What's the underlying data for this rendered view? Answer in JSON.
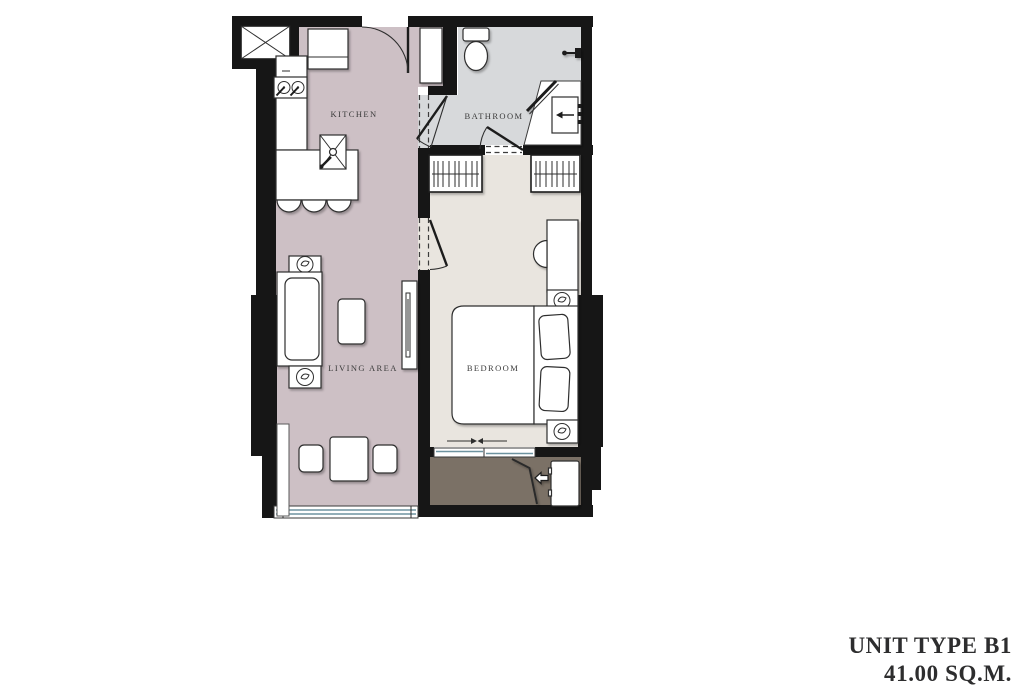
{
  "unit": {
    "title_line1": "UNIT TYPE B1",
    "title_line2": "41.00 SQ.M."
  },
  "rooms": {
    "kitchen": {
      "label": "KITCHEN"
    },
    "bathroom": {
      "label": "BATHROOM"
    },
    "living_area": {
      "label": "LIVING AREA"
    },
    "bedroom": {
      "label": "BEDROOM"
    }
  },
  "colors": {
    "wall": "#161616",
    "kitchen_living_floor": "#cdc0c5",
    "bathroom_floor": "#d7d9db",
    "bedroom_floor": "#e9e5df",
    "balcony_floor": "#7b7166",
    "glazing": "#6e93a0",
    "label_text": "#3a3a3a",
    "title_text": "#2d2d2e"
  }
}
